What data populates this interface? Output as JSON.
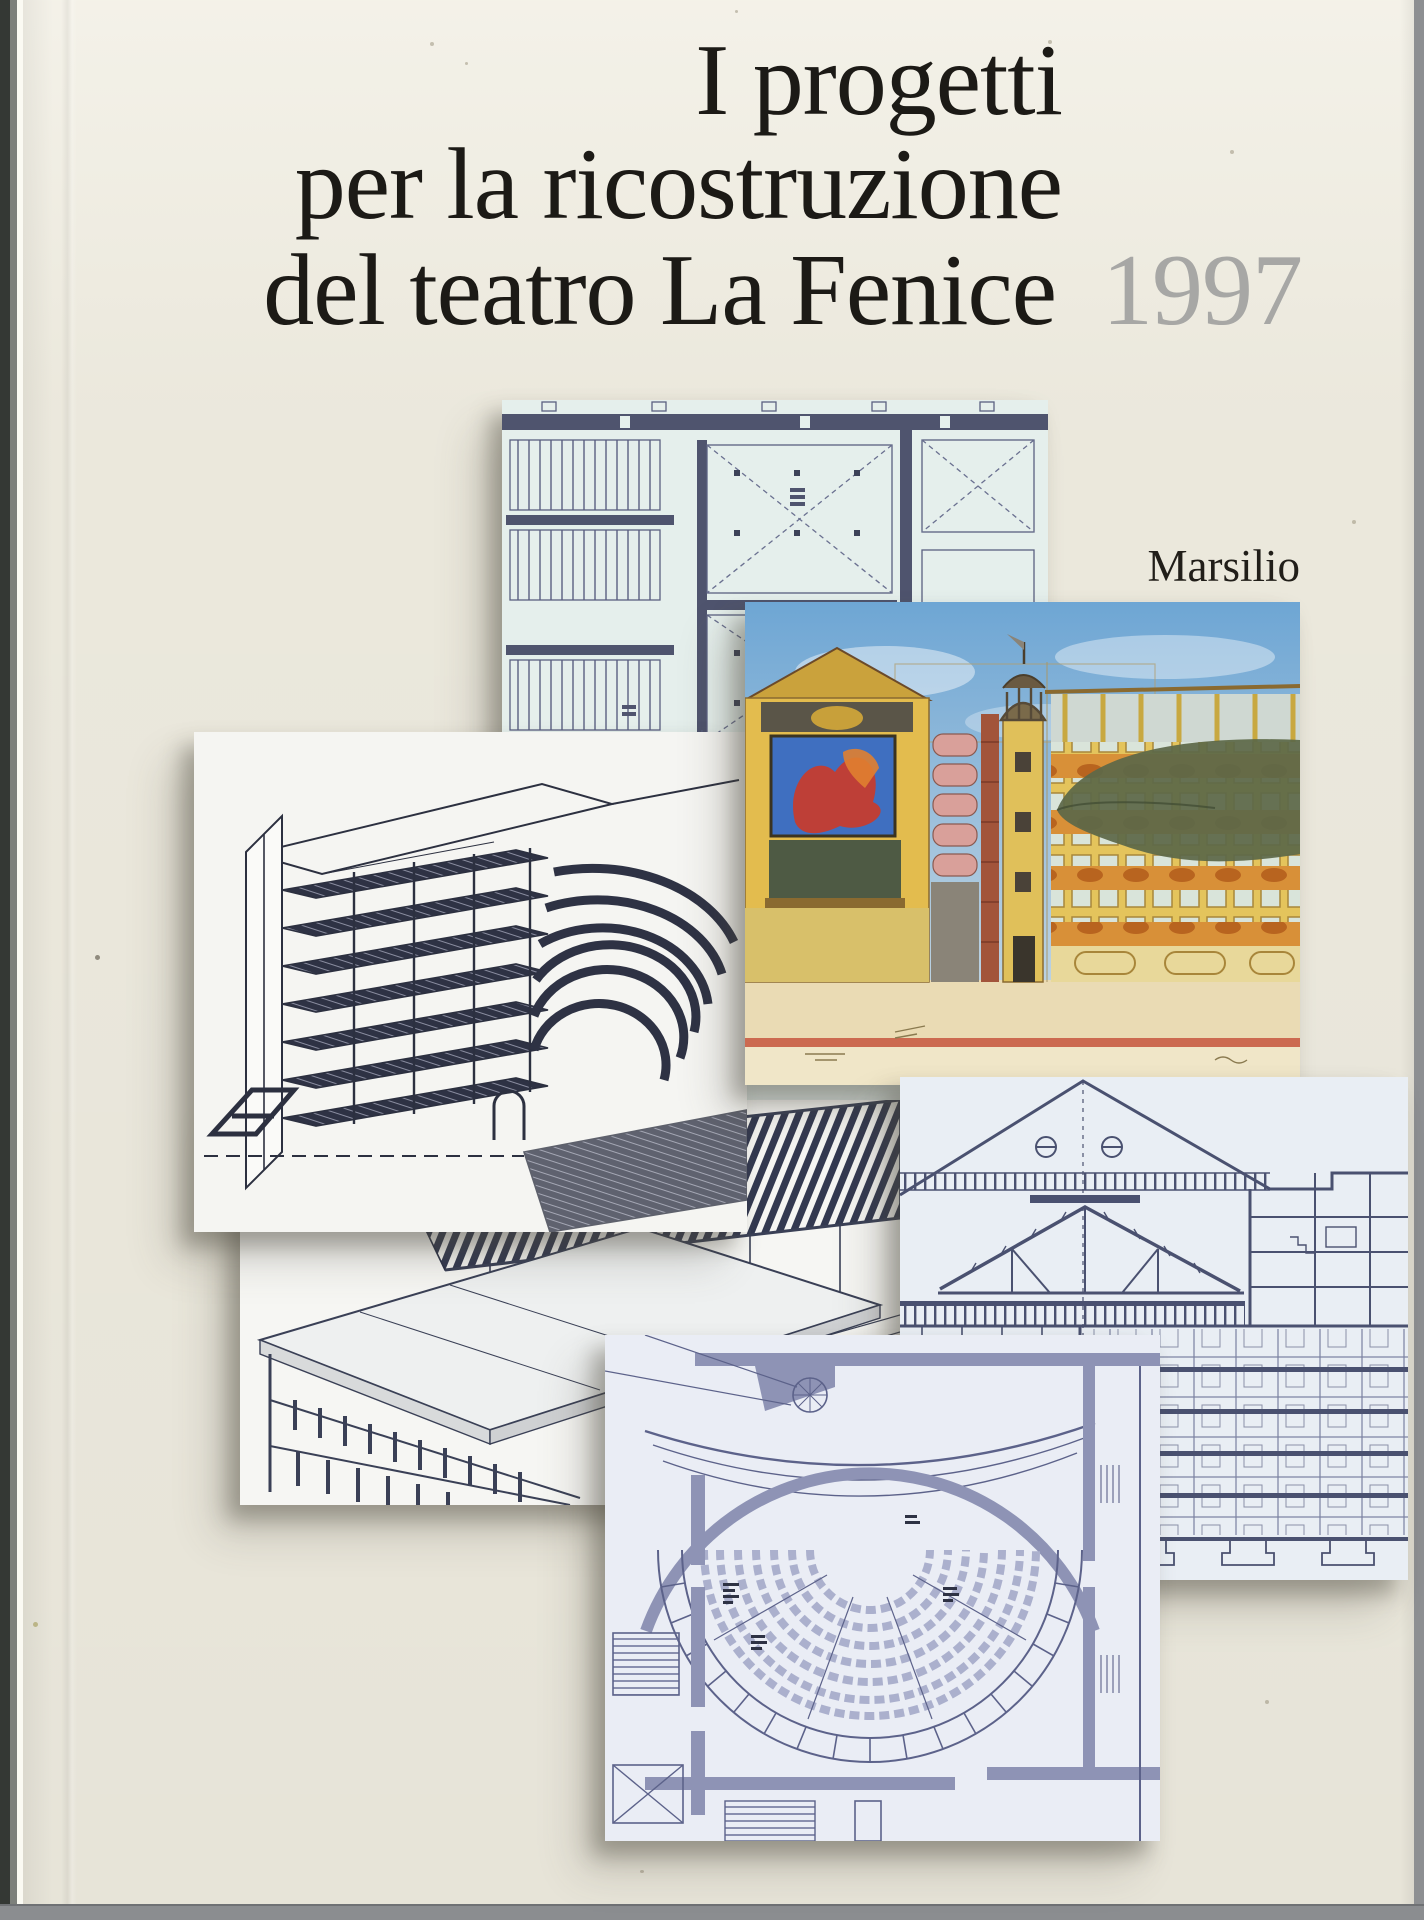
{
  "cover": {
    "title_line1": "I progetti",
    "title_line2": "per la ricostruzione",
    "title_line3": "del teatro La Fenice",
    "year": "1997",
    "publisher": "Marsilio"
  },
  "collage": {
    "items": [
      {
        "name": "floor-plan-drawing",
        "kind": "blue-line architectural floor plan with stairs and braced halls"
      },
      {
        "name": "structural-axonometric-drawing",
        "kind": "black and white cutaway axonometric of theater hall structure"
      },
      {
        "name": "watercolor-section-drawing",
        "kind": "watercolor cross-section with campanile, stage mural and tiered facade"
      },
      {
        "name": "roof-axonometric-drawing",
        "kind": "axonometric of louvered roof structure over facade"
      },
      {
        "name": "building-section-drawing",
        "kind": "transverse building section with gable roof truss"
      },
      {
        "name": "auditorium-plan-drawing",
        "kind": "horseshoe auditorium seating plan"
      }
    ]
  },
  "colors": {
    "cover_cream": "#f0ede1",
    "title_black": "#1c1a16",
    "year_gray": "#a7a7a5",
    "plan_background": "#e5efec",
    "drawing_ink": "#3c4258",
    "plan2_wall": "#8e93b5",
    "watercolor_sky": "#7fb0d8",
    "watercolor_yellow": "#e0bc4e",
    "photo_background": "#8d8f92"
  }
}
